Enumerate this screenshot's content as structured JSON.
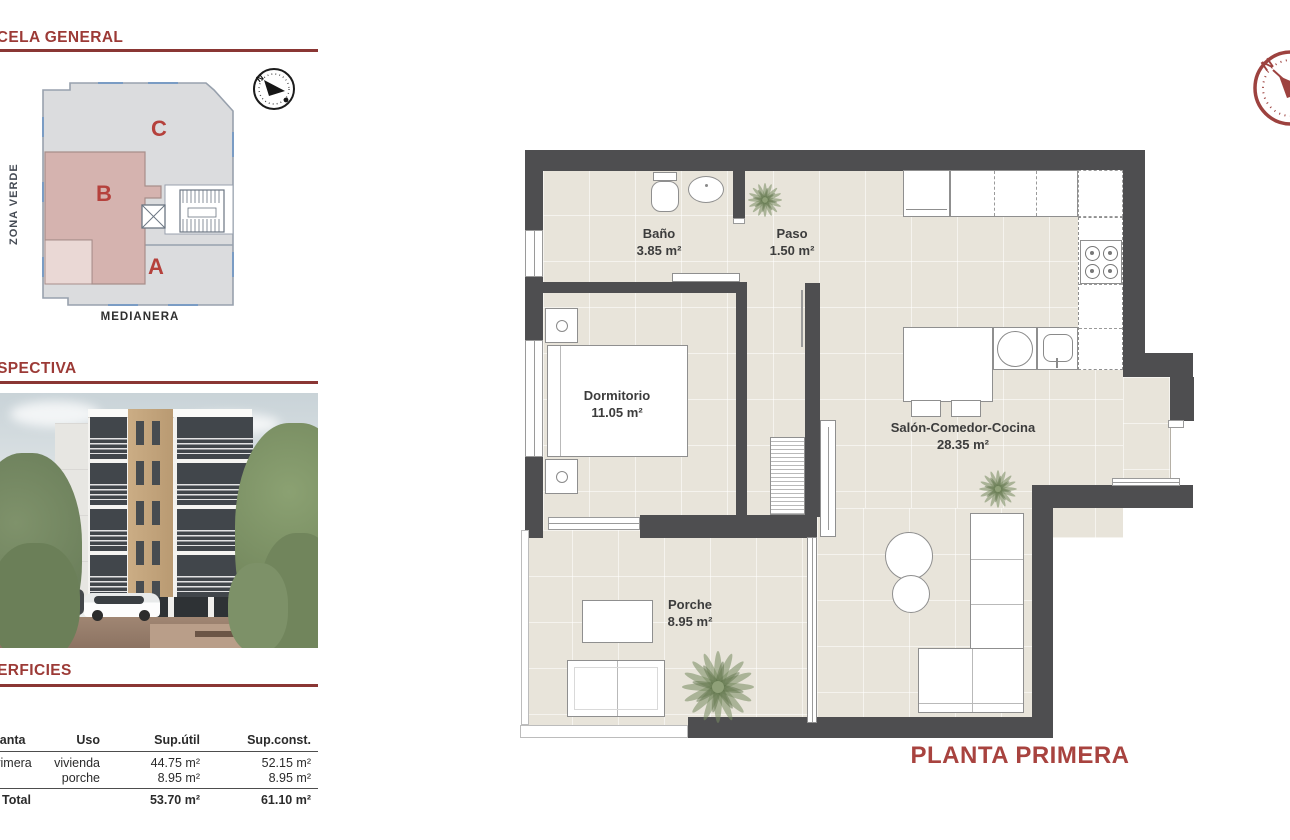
{
  "sections": {
    "parcela_general": {
      "title": "PARCELA GENERAL"
    },
    "perspectiva": {
      "title": "PERSPECTIVA"
    },
    "superficies": {
      "title": "SUPERFICIES"
    }
  },
  "site_plan": {
    "zone_a": "A",
    "zone_b": "B",
    "zone_c": "C",
    "zona_verde_label": "ZONA VERDE",
    "medianera_label": "MEDIANERA",
    "compass_north": "N"
  },
  "surfaces_table": {
    "headers": {
      "planta": "Planta",
      "uso": "Uso",
      "sup_util": "Sup.útil",
      "sup_const": "Sup.const."
    },
    "row1": {
      "planta": "Primera",
      "uso": "vivienda",
      "sup_util": "44.75 m²",
      "sup_const": "52.15 m²"
    },
    "row2": {
      "uso": "porche",
      "sup_util": "8.95 m²",
      "sup_const": "8.95 m²"
    },
    "total": {
      "label": "Total",
      "sup_util": "53.70 m²",
      "sup_const": "61.10 m²"
    }
  },
  "floor_plan": {
    "sheet_title": "PLANTA PRIMERA",
    "compass_north": "N",
    "rooms": {
      "bano": {
        "name": "Baño",
        "area": "3.85 m²"
      },
      "paso": {
        "name": "Paso",
        "area": "1.50 m²"
      },
      "dormitorio": {
        "name": "Dormitorio",
        "area": "11.05 m²"
      },
      "salon": {
        "name": "Salón-Comedor-Cocina",
        "area": "28.35 m²"
      },
      "porche": {
        "name": "Porche",
        "area": "8.95 m²"
      }
    }
  },
  "colors": {
    "heading_red": "#9c3a36",
    "sheet_title_red": "#a8433f",
    "zone_letter_red": "#b5413c",
    "wall_gray": "#4e4e50",
    "floor_beige": "#e8e4da",
    "zone_b_pink": "#d5b3af"
  }
}
